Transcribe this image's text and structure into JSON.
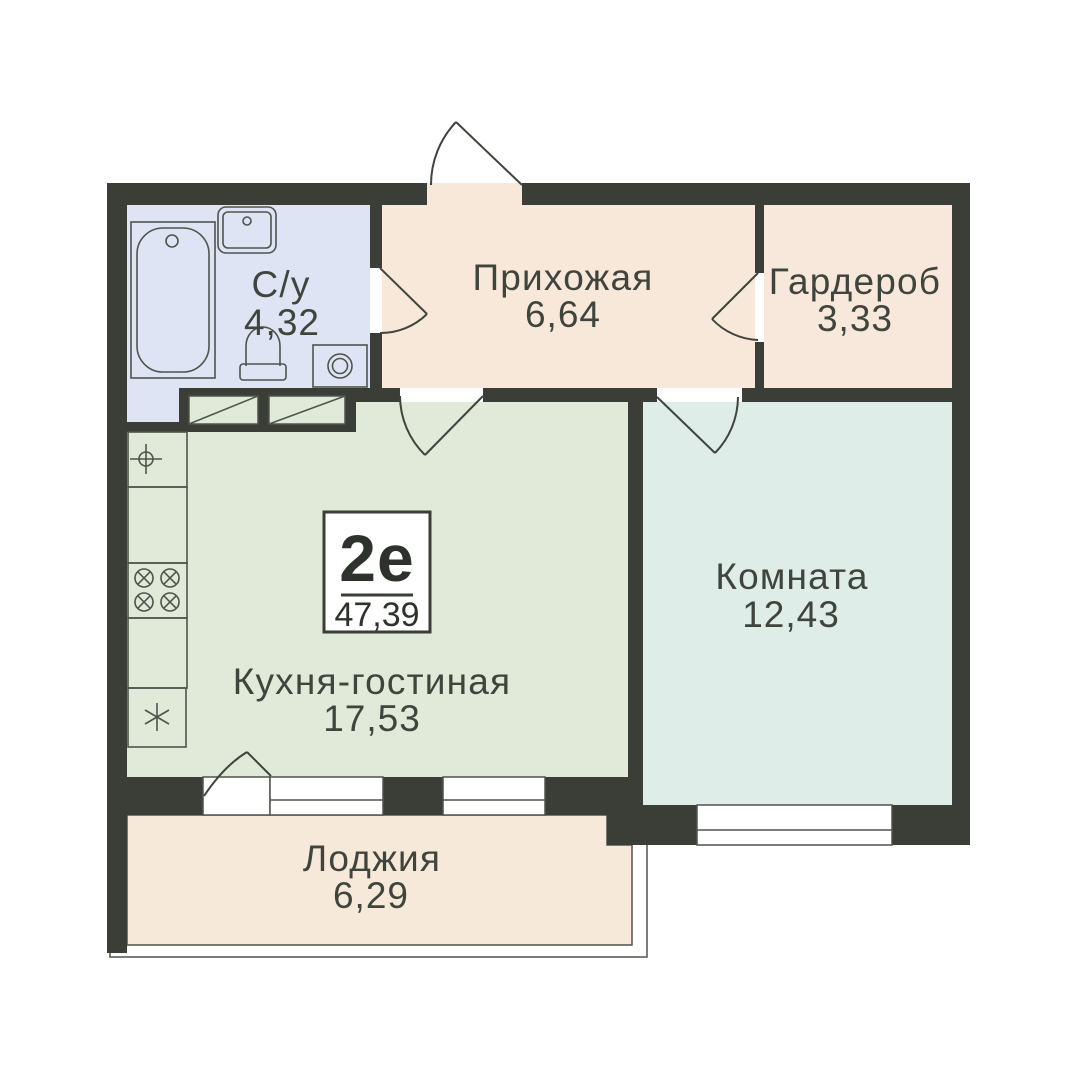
{
  "plan": {
    "badge": {
      "type": "2е",
      "area": "47,39"
    },
    "rooms": [
      {
        "id": "bathroom",
        "label": "С/у",
        "area": "4,32"
      },
      {
        "id": "hallway",
        "label": "Прихожая",
        "area": "6,64"
      },
      {
        "id": "wardrobe",
        "label": "Гардероб",
        "area": "3,33"
      },
      {
        "id": "kitchen-living",
        "label": "Кухня-гостиная",
        "area": "17,53"
      },
      {
        "id": "room",
        "label": "Комната",
        "area": "12,43"
      },
      {
        "id": "loggia",
        "label": "Лоджия",
        "area": "6,29"
      }
    ],
    "fixtures": [
      "bathtub-icon",
      "sink-icon",
      "toilet-icon",
      "washing-machine-icon",
      "kitchen-sink-icon",
      "stove-icon",
      "fridge-icon",
      "closet-icon"
    ],
    "colors": {
      "wall": "#3a3e37",
      "line": "#4f544c",
      "door": "#3f443c",
      "text": "#3f443c",
      "bathroom": "#dfe4f4",
      "hallway": "#f8e8da",
      "wardrobe": "#f7e8db",
      "kitchen": "#e1e9d9",
      "room": "#dfede8",
      "loggia": "#f6e9d9"
    }
  }
}
